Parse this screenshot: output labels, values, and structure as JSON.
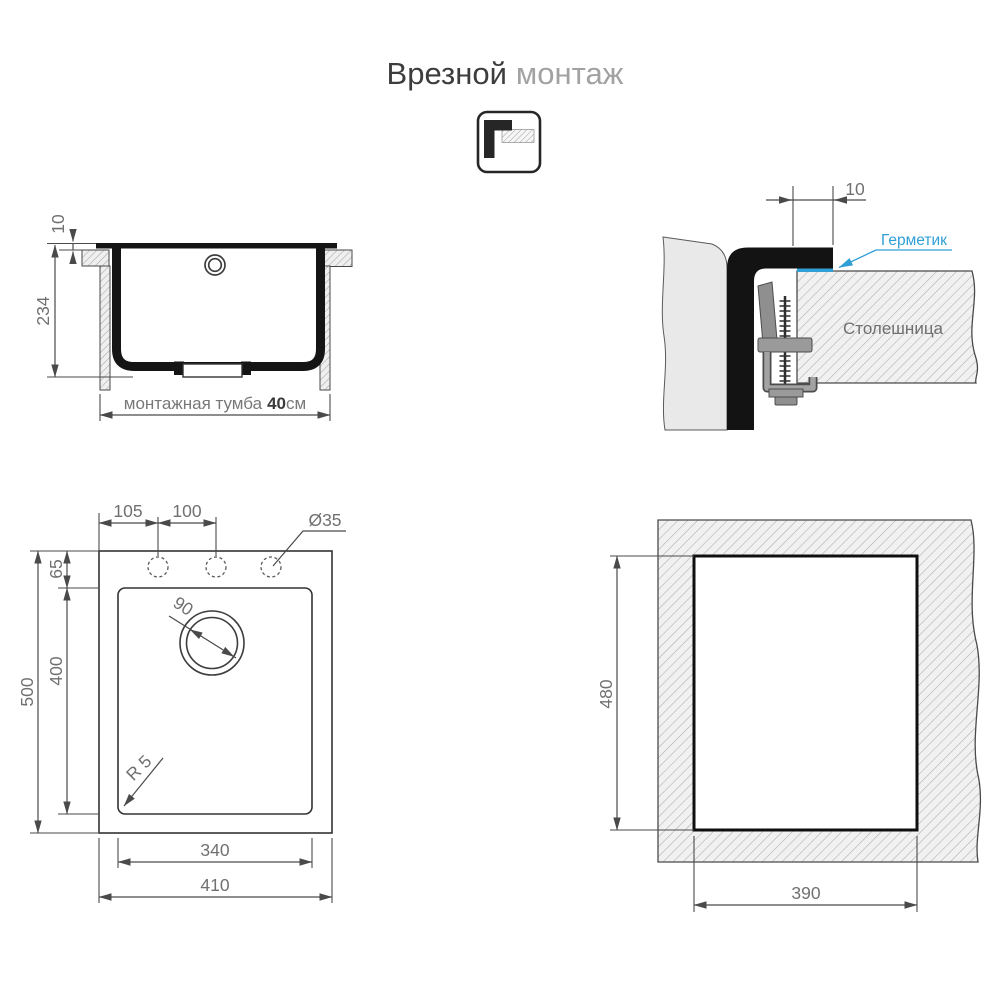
{
  "title": {
    "primary": "Врезной",
    "secondary": "монтаж"
  },
  "icon": {
    "name": "inset-mount-icon"
  },
  "colors": {
    "accent_blue": "#2f9fd6",
    "drawing_black": "#151515",
    "dim_gray": "#707070"
  },
  "views": {
    "cross_section": {
      "dim_rim_above": "10",
      "dim_depth": "234",
      "cabinet_label": "монтажная тумба",
      "cabinet_size": "40",
      "cabinet_unit": "см"
    },
    "mount_detail": {
      "dim_overlap": "10",
      "sealant_label": "Герметик",
      "countertop_label": "Столешница"
    },
    "top_view": {
      "dim_hole_offset": "105",
      "dim_hole_spacing": "100",
      "dim_hole_diameter": "Ø35",
      "dim_edge_to_bowl": "65",
      "dim_bowl_length": "400",
      "dim_total_length": "500",
      "dim_drain_diameter": "90",
      "dim_corner_radius": "R 5",
      "dim_bowl_width": "340",
      "dim_total_width": "410"
    },
    "cutout": {
      "dim_height": "480",
      "dim_width": "390"
    }
  }
}
